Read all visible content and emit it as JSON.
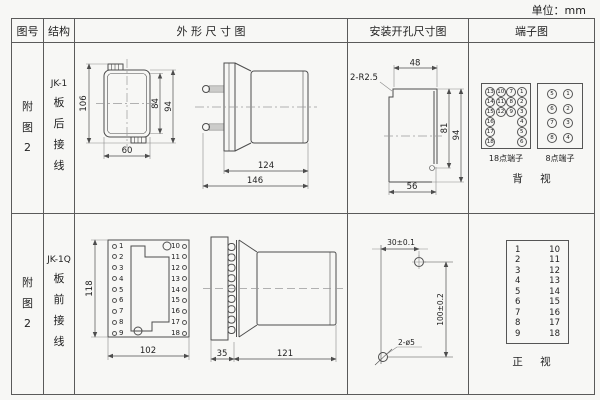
{
  "unit_note": "单位：mm",
  "header": {
    "col_figure": "图号",
    "col_structure": "结构",
    "col_outline": "外 形 尺 寸 图",
    "col_mounting": "安装开孔尺寸图",
    "col_terminal": "端子图"
  },
  "rows": [
    {
      "figure_no": "附图2",
      "structure_model": "JK-1",
      "structure_wiring": "板后接线",
      "outline": {
        "dim_height_overall": "106",
        "dim_height_inner": "84",
        "dim_height_outer": "94",
        "dim_width": "60",
        "dim_body_len": "124",
        "dim_total_len": "146"
      },
      "mounting": {
        "callout": "2-R2.5",
        "dim_top": "48",
        "dim_inner_h": "81",
        "dim_outer_h": "94",
        "dim_bottom": "56"
      },
      "terminal": {
        "grid18": [
          "13",
          "10",
          "7",
          "1",
          "14",
          "11",
          "8",
          "2",
          "15",
          "12",
          "9",
          "3",
          "16",
          "",
          "",
          "4",
          "17",
          "",
          "",
          "5",
          "18",
          "",
          "",
          "6"
        ],
        "grid8": [
          "5",
          "1",
          "6",
          "2",
          "7",
          "3",
          "8",
          "4"
        ],
        "label18": "18点端子",
        "label8": "8点端子",
        "view_label": "背 视"
      }
    },
    {
      "figure_no": "附图2",
      "structure_model": "JK-1Q",
      "structure_wiring": "板前接线",
      "outline": {
        "dim_height": "118",
        "dim_width": "102",
        "dim_flange_len": "35",
        "dim_body_len": "121",
        "terminals_left": [
          "1",
          "2",
          "3",
          "4",
          "5",
          "6",
          "7",
          "8",
          "9"
        ],
        "terminals_right": [
          "10",
          "11",
          "12",
          "13",
          "14",
          "15",
          "16",
          "17",
          "18"
        ]
      },
      "mounting": {
        "dim_horizontal": "30±0.1",
        "dim_vertical": "100±0.2",
        "callout": "2-ø5"
      },
      "terminal": {
        "pairs": [
          {
            "l": "1",
            "r": "10"
          },
          {
            "l": "2",
            "r": "11"
          },
          {
            "l": "3",
            "r": "12"
          },
          {
            "l": "4",
            "r": "13"
          },
          {
            "l": "5",
            "r": "14"
          },
          {
            "l": "6",
            "r": "15"
          },
          {
            "l": "7",
            "r": "16"
          },
          {
            "l": "8",
            "r": "17"
          },
          {
            "l": "9",
            "r": "18"
          }
        ],
        "view_label": "正 视"
      }
    }
  ]
}
